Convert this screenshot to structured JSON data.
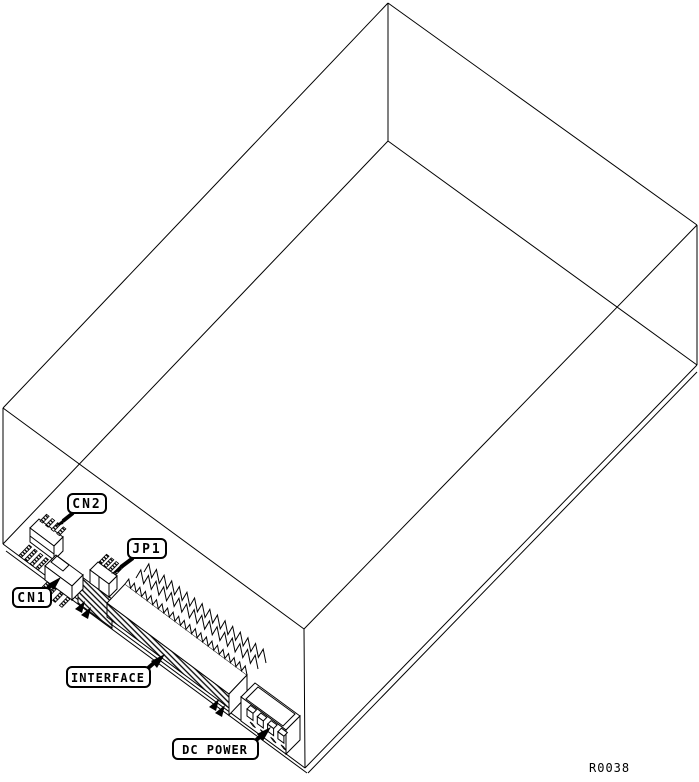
{
  "diagram": {
    "drawing_number": "R0038",
    "background_color": "#ffffff",
    "line_color": "#000000"
  },
  "callouts": {
    "cn2": "CN2",
    "jp1": "JP1",
    "cn1": "CN1",
    "interface": "INTERFACE",
    "dc_power": "DC POWER"
  }
}
